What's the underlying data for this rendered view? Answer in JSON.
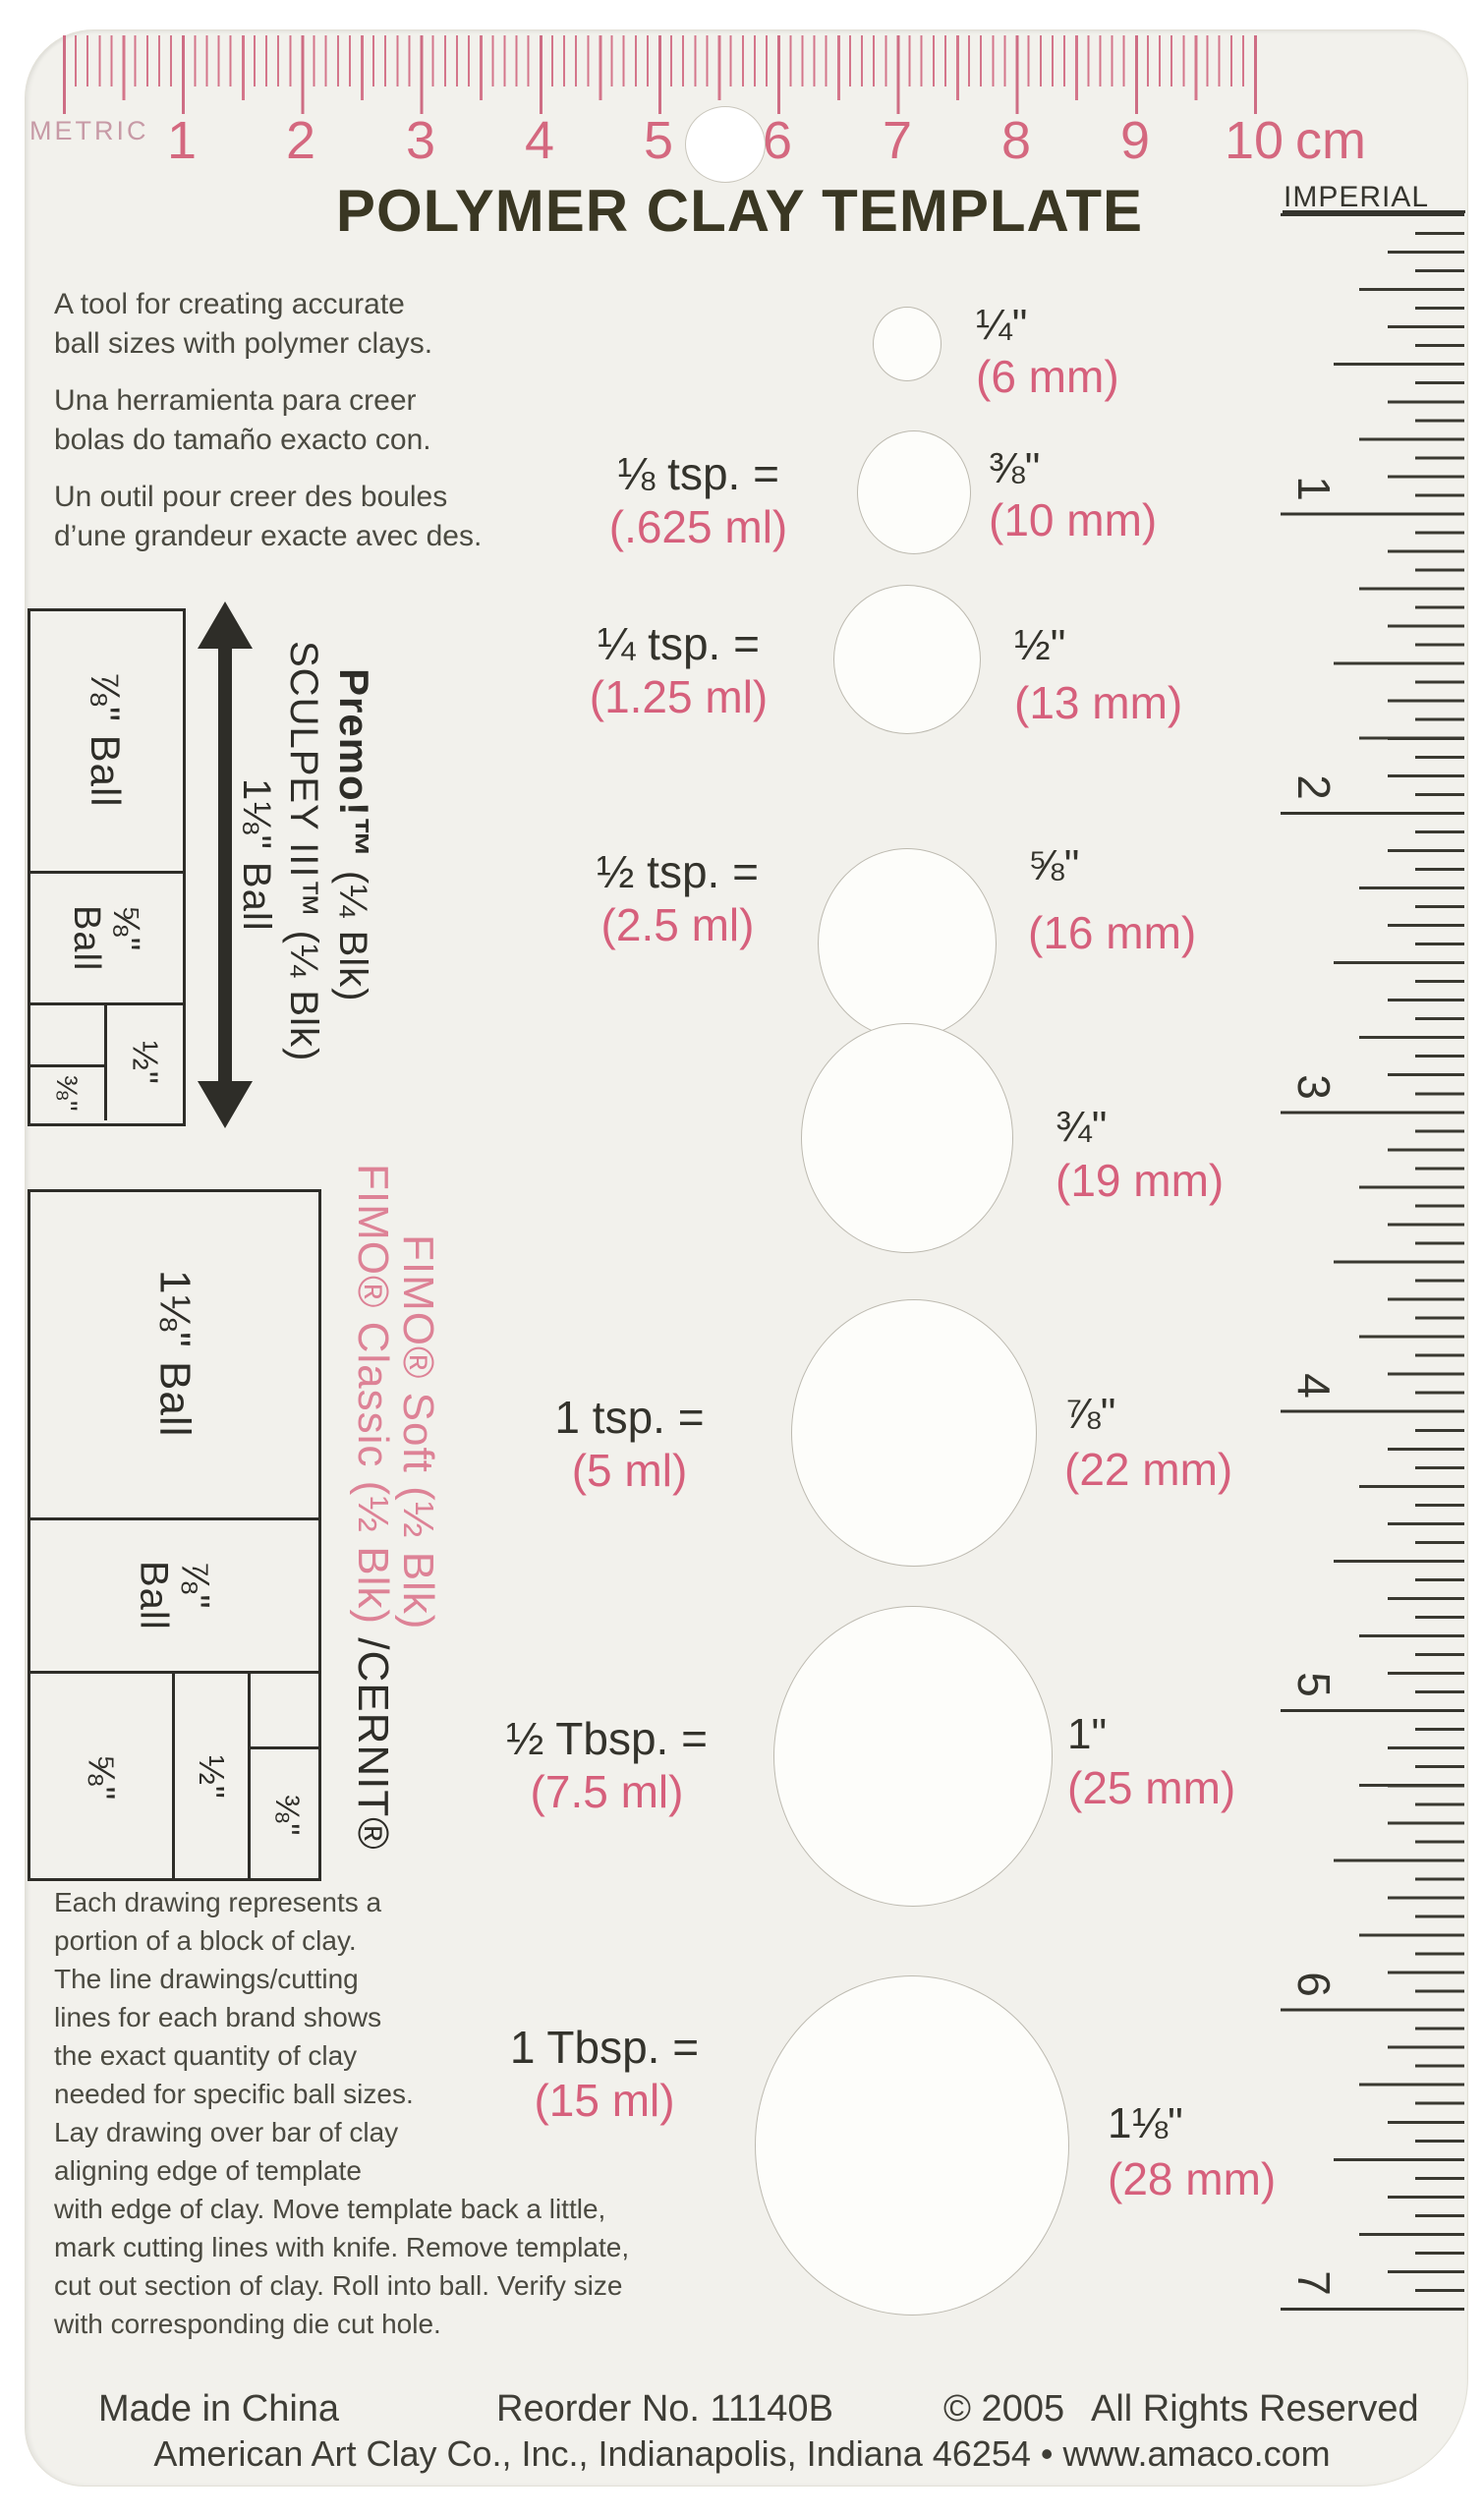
{
  "title": "POLYMER CLAY TEMPLATE",
  "colors": {
    "plate": "#f2f1ec",
    "ruler_pink": "#d4768b",
    "accent_pink": "#d6607c",
    "fimo_pink": "#dd8296",
    "ink": "#34332c"
  },
  "metric_ruler": {
    "label": "METRIC",
    "unit": "cm",
    "numbers": [
      "1",
      "2",
      "3",
      "4",
      "5",
      "6",
      "7",
      "8",
      "9",
      "10"
    ]
  },
  "imperial_ruler": {
    "label": "IMPERIAL",
    "numbers": [
      "1",
      "2",
      "3",
      "4",
      "5",
      "6",
      "7"
    ]
  },
  "intro": {
    "en": "A tool for creating accurate\nball sizes with polymer clays.",
    "es": "Una herramienta para creer\nbolas do tamaño exacto con.",
    "fr": "Un outil pour creer des boules\nd’une grandeur exacte avec des."
  },
  "holes": [
    {
      "inch": "¼\"",
      "mm": "(6 mm)",
      "amount": "",
      "ml": ""
    },
    {
      "inch": "⅜\"",
      "mm": "(10 mm)",
      "amount": "⅛ tsp. =",
      "ml": "(.625 ml)"
    },
    {
      "inch": "½\"",
      "mm": "(13 mm)",
      "amount": "¼ tsp. =",
      "ml": "(1.25 ml)"
    },
    {
      "inch": "⅝\"",
      "mm": "(16 mm)",
      "amount": "½ tsp. =",
      "ml": "(2.5 ml)"
    },
    {
      "inch": "¾\"",
      "mm": "(19 mm)",
      "amount": "",
      "ml": ""
    },
    {
      "inch": "⅞\"",
      "mm": "(22 mm)",
      "amount": "1 tsp. =",
      "ml": "(5 ml)"
    },
    {
      "inch": "1\"",
      "mm": "(25 mm)",
      "amount": "½ Tbsp. =",
      "ml": "(7.5 ml)"
    },
    {
      "inch": "1⅛\"",
      "mm": "(28 mm)",
      "amount": "1 Tbsp. =",
      "ml": "(15 ml)"
    }
  ],
  "premo_diagram": {
    "brand_primary": "Premo!™",
    "brand_primary_suffix": " (¼ Blk)",
    "brand_secondary": "SCULPEY III™ (¼ Blk)",
    "arrow_label": "1⅛\" Ball",
    "cell_78": "⅞\" Ball",
    "cell_58": "⅝\"\nBall",
    "cell_12": "½\"",
    "cell_38": "⅜\""
  },
  "fimo_diagram": {
    "brand_soft": "FIMO® Soft (½ Blk)",
    "brand_classic": "FIMO® Classic (½ Blk) ",
    "brand_cernit": "/CERNIT®",
    "cell_118": "1⅛\" Ball",
    "cell_78": "⅞\"\nBall",
    "cell_58": "⅝\"",
    "cell_12": "½\"",
    "cell_38": "⅜\""
  },
  "instructions": "Each drawing represents a\nportion of a block of clay.\nThe line drawings/cutting\nlines for each brand shows\nthe exact quantity of clay\nneeded for specific ball sizes.\nLay drawing over bar of clay\naligning edge of template\nwith edge of clay. Move template back a little,\nmark cutting lines with knife. Remove template,\ncut out section of clay. Roll into ball. Verify size\nwith corresponding die cut hole.",
  "footer": {
    "made_in": "Made in China",
    "reorder": "Reorder No. 11140B",
    "copyright": "© 2005",
    "rights": "All Rights Reserved",
    "company_line": "American Art Clay Co., Inc., Indianapolis, Indiana 46254 • www.amaco.com"
  }
}
